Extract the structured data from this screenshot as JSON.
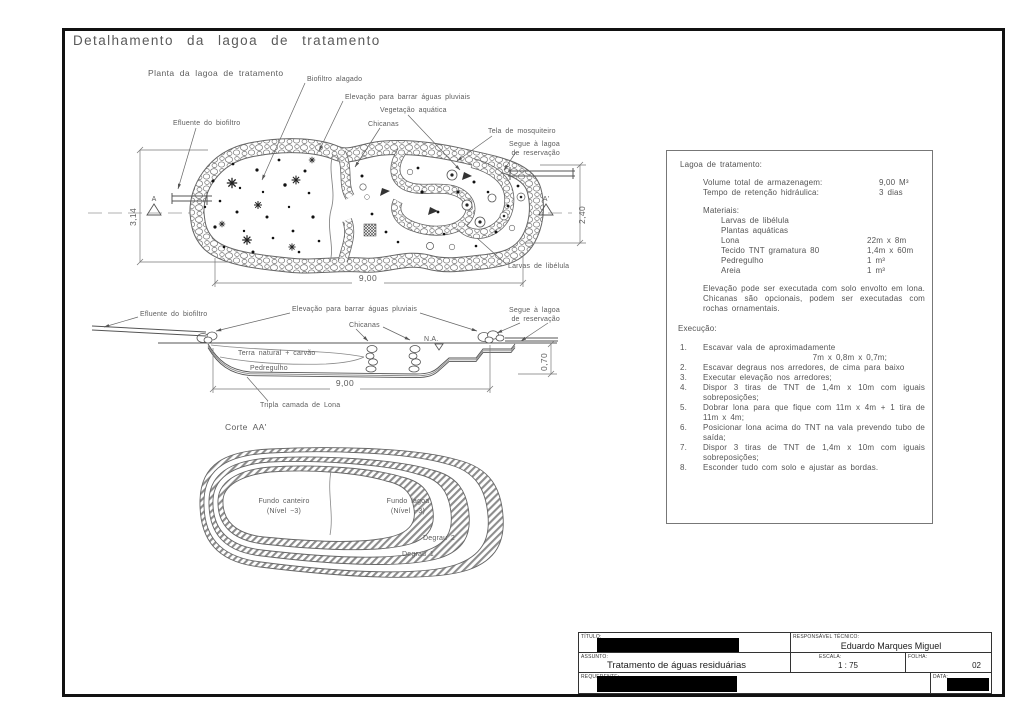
{
  "page": {
    "title": "Detalhamento da lagoa de tratamento"
  },
  "plan": {
    "caption": "Planta da lagoa de tratamento",
    "labels": {
      "biofiltro": "Biofiltro alagado",
      "elevacao": "Elevação para barrar águas pluviais",
      "vegetacao": "Vegetação aquática",
      "chicanas": "Chicanas",
      "tela": "Tela de mosquiteiro",
      "segue1": "Segue à lagoa",
      "segue2": "de reservação",
      "efluente": "Efluente do biofiltro",
      "larvas": "Larvas de libélula"
    },
    "dims": {
      "width": "9,00",
      "left_height": "3,14",
      "right_height": "2,40"
    },
    "markers": {
      "left": "A",
      "right": "A'"
    }
  },
  "section": {
    "caption": "Corte AA'",
    "labels": {
      "efluente": "Efluente do biofiltro",
      "elevacao": "Elevação para barrar águas pluviais",
      "chicanas": "Chicanas",
      "na": "N.A.",
      "segue1": "Segue à lagoa",
      "segue2": "de reservação",
      "terra": "Terra natural + carvão",
      "pedregulho": "Pedregulho",
      "lona": "Tripla camada de Lona"
    },
    "dims": {
      "width": "9,00",
      "depth": "0,70"
    }
  },
  "bottom_view": {
    "labels": {
      "fundo_canteiro": "Fundo canteiro",
      "fundo_canteiro_nivel": "(Nível −3)",
      "fundo_lagoa": "Fundo lagoa",
      "fundo_lagoa_nivel": "(Nível −3)",
      "degrau2": "Degrau 2",
      "degrau1": "Degrau 1"
    }
  },
  "info_panel": {
    "heading": "Lagoa de tratamento:",
    "specs": [
      {
        "label": "Volume total de armazenagem:",
        "value": "9,00 M³"
      },
      {
        "label": "Tempo de retenção hidráulica:",
        "value": "3 dias"
      }
    ],
    "materials_heading": "Materiais:",
    "materials": [
      {
        "name": "Larvas de libélula",
        "qty": ""
      },
      {
        "name": "Plantas aquáticas",
        "qty": ""
      },
      {
        "name": "Lona",
        "qty": "22m x 8m"
      },
      {
        "name": "Tecido TNT gramatura 80",
        "qty": "1,4m x 60m"
      },
      {
        "name": "Pedregulho",
        "qty": "1 m³"
      },
      {
        "name": "Areia",
        "qty": "1 m³"
      }
    ],
    "note": "Elevação pode ser executada com solo envolto em lona. Chicanas são opcionais, podem ser executadas com rochas ornamentais.",
    "execution_heading": "Execução:",
    "steps": [
      {
        "num": "1.",
        "text": "Escavar vala de aproximadamente",
        "text2": "7m x 0,8m x 0,7m;"
      },
      {
        "num": "2.",
        "text": "Escavar degraus nos arredores, de cima para baixo"
      },
      {
        "num": "3.",
        "text": "Executar elevação nos arredores;"
      },
      {
        "num": "4.",
        "text": "Dispor 3 tiras de TNT de 1,4m x 10m com iguais sobreposições;"
      },
      {
        "num": "5.",
        "text": "Dobrar lona para que fique com 11m x 4m + 1 tira de 11m x 4m;"
      },
      {
        "num": "6.",
        "text": "Posicionar lona acima do TNT na vala prevendo tubo de saída;"
      },
      {
        "num": "7.",
        "text": "Dispor 3 tiras de TNT de 1,4m x 10m com iguais sobreposições;"
      },
      {
        "num": "8.",
        "text": "Esconder tudo com solo e ajustar as bordas."
      }
    ]
  },
  "title_block": {
    "titulo_label": "TÍTULO:",
    "responsavel_label": "RESPONSÁVEL TÉCNICO:",
    "responsavel_value": "Eduardo Marques Miguel",
    "assunto_label": "ASSUNTO:",
    "assunto_value": "Tratamento de águas residuárias",
    "escala_label": "ESCALA:",
    "escala_value": "1 : 75",
    "folha_label": "FOLHA:",
    "folha_value": "02",
    "requerente_label": "REQUERENTE:",
    "data_label": "DATA:"
  },
  "colors": {
    "line": "#555555",
    "text": "#5c5c5c",
    "redaction": "#000000",
    "background": "#ffffff"
  }
}
